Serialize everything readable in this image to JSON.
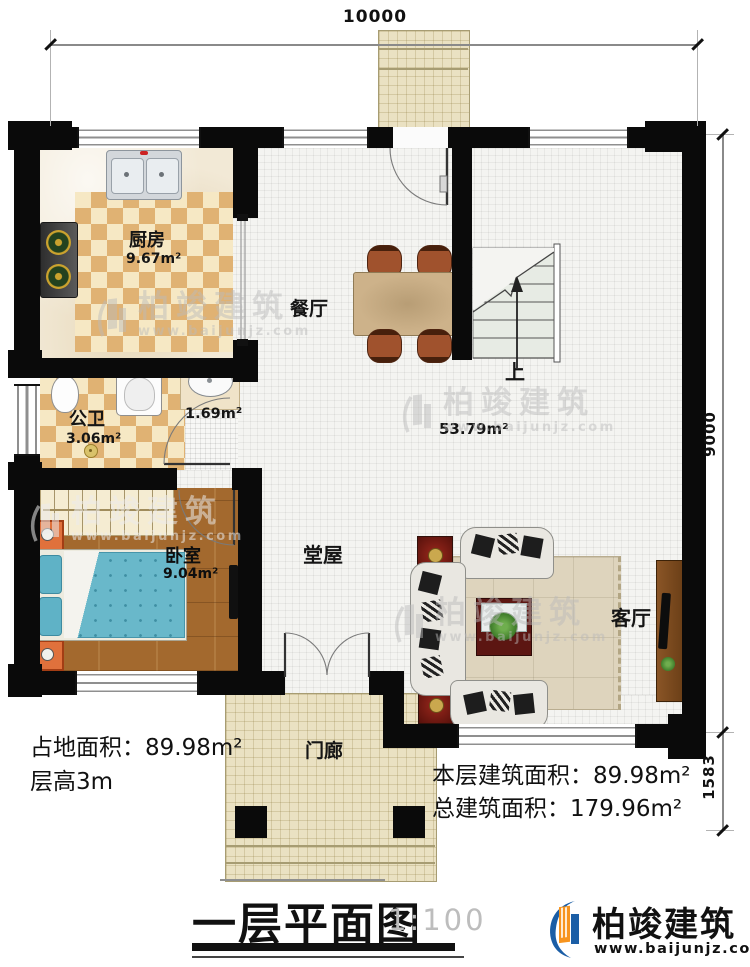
{
  "plan": {
    "dims": {
      "width_top": "10000",
      "height_main": "9000",
      "height_porch": "1583"
    },
    "rooms": {
      "kitchen": {
        "name": "厨房",
        "area": "9.67m²"
      },
      "dining": {
        "name": "餐厅"
      },
      "bath": {
        "name": "公卫",
        "area": "3.06m²"
      },
      "basin": {
        "area": "1.69m²"
      },
      "bedroom": {
        "name": "卧室",
        "area": "9.04m²"
      },
      "hall": {
        "name": "堂屋",
        "area": "53.79m²"
      },
      "living": {
        "name": "客厅"
      },
      "porch": {
        "name": "门廊"
      },
      "stair": {
        "up": "上"
      }
    }
  },
  "notes": {
    "site_area": "占地面积：89.98m²",
    "floor_height": "层高3m",
    "floor_area": "本层建筑面积：89.98m²",
    "total_area": "总建筑面积：179.96m²"
  },
  "footer": {
    "title": "一层平面图",
    "scale": "1:100",
    "brand": "柏竣建筑",
    "site": "www.baijunjz.com"
  },
  "watermark": {
    "brand": "柏竣建筑",
    "site": "www.baijunjz.com"
  },
  "colors": {
    "wall": "#0a0a0a",
    "checker_tan": "#e0b273",
    "wood": "#a3692e",
    "logo_blue": "#1b5ea6",
    "logo_orange": "#f7941e"
  }
}
